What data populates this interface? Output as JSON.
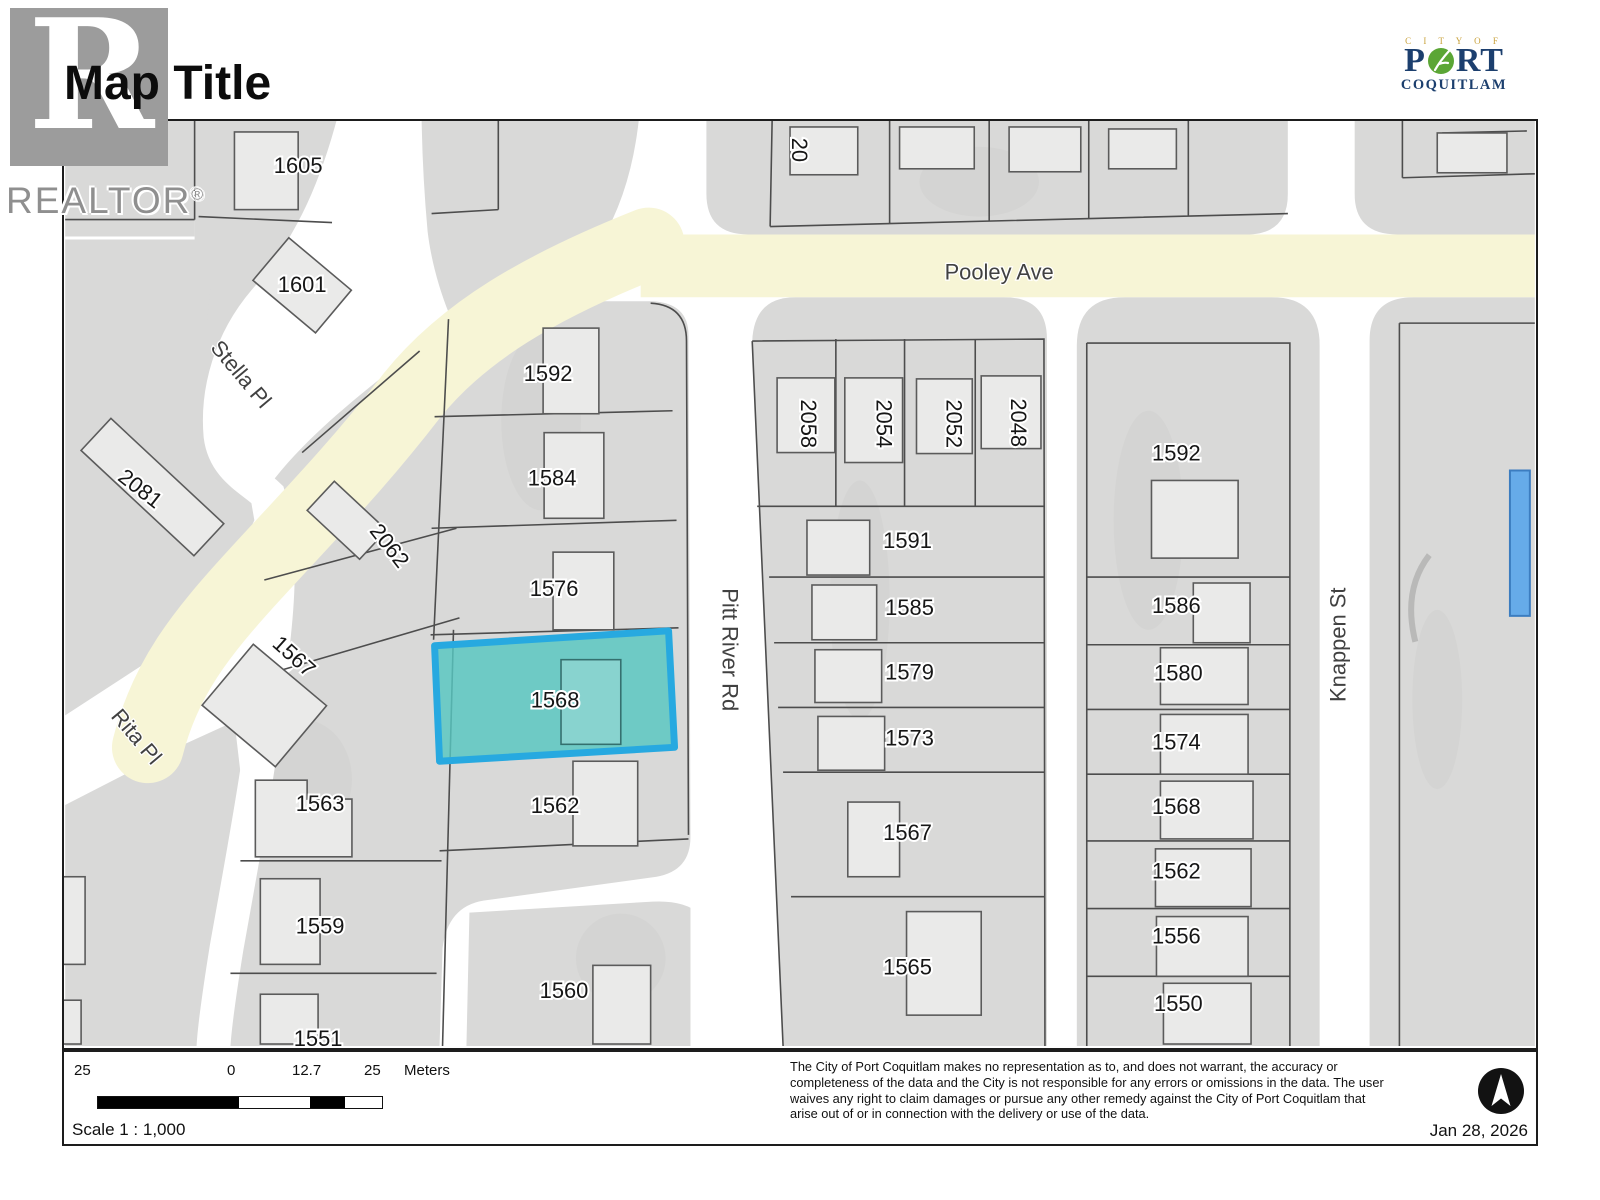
{
  "header": {
    "title": "Map Title",
    "realtor_letter": "R",
    "realtor_text": "REALTOR",
    "realtor_reg": "®",
    "city_logo": {
      "city_of": "C I T Y   O F",
      "port_p": "P",
      "port_rt": "RT",
      "coquitlam": "COQUITLAM",
      "navy": "#1c3f6e",
      "green": "#5ba635",
      "gold": "#c9a23c"
    }
  },
  "map": {
    "streets": {
      "pooley": "Pooley Ave",
      "pitt_river": "Pitt River Rd",
      "stella": "Stella Pl",
      "rita": "Rita Pl",
      "knappen": "Knappen St"
    },
    "labels": {
      "l20": "20",
      "l1605": "1605",
      "l1601": "1601",
      "l2081": "2081",
      "l2062": "2062",
      "l1567w": "1567",
      "l1563": "1563",
      "l1559": "1559",
      "l1551": "1551",
      "l1592c": "1592",
      "l1584": "1584",
      "l1576": "1576",
      "l1568h": "1568",
      "l1562c": "1562",
      "l1560": "1560",
      "l2058": "2058",
      "l2054": "2054",
      "l2052": "2052",
      "l2048": "2048",
      "l1591": "1591",
      "l1585": "1585",
      "l1579": "1579",
      "l1573": "1573",
      "l1567e": "1567",
      "l1565": "1565",
      "l1592e": "1592",
      "l1586": "1586",
      "l1580": "1580",
      "l1574": "1574",
      "l1568e": "1568",
      "l1562e": "1562",
      "l1556": "1556",
      "l1550": "1550"
    },
    "highlight": {
      "label": "1568",
      "fill": "#57c7c1",
      "border": "#27a9e0"
    },
    "colors": {
      "road_yellow": "#f7f5d6",
      "block_gray": "#d9d9d8",
      "building_fill": "#eaeae9",
      "parcel_line": "#4d4d4d",
      "blue_feature": "#66abe9"
    }
  },
  "footer": {
    "scale_labels": {
      "left": "25",
      "zero": "0",
      "mid": "12.7",
      "right": "25",
      "unit": "Meters"
    },
    "scale_text": "Scale  1 : 1,000",
    "disclaimer": "The City of Port Coquitlam makes no representation as to, and does not warrant, the accuracy or completeness of the data and the City is not responsible for any errors or omissions in the data.  The user waives any right to claim damages or pursue any other remedy against the City of Port Coquitlam that arise out of or in connection with the delivery or use of the data.",
    "date": "Jan 28, 2026"
  }
}
